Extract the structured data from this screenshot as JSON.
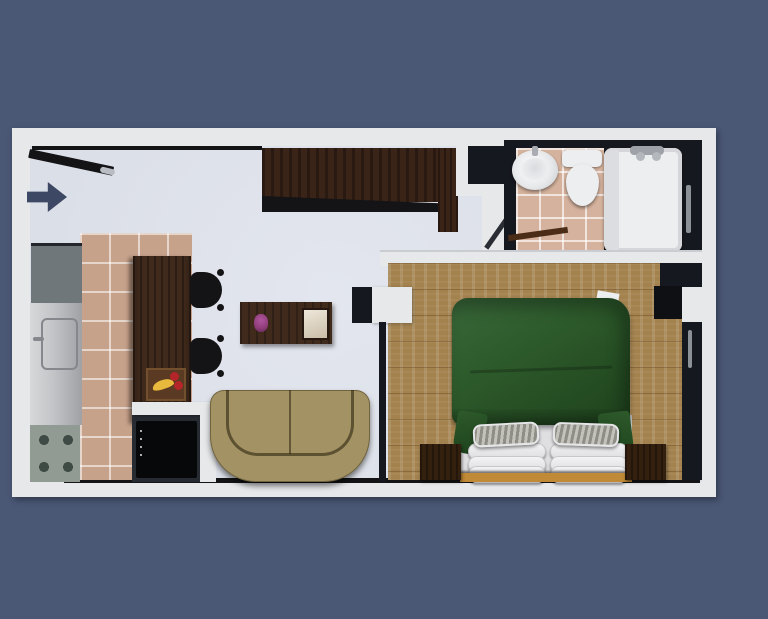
{
  "meta": {
    "description": "3D rendered top-down floor plan of a studio apartment",
    "render_style": "architectural color render on slate-blue background"
  },
  "palette": {
    "bg": "#4a5775",
    "wall": "#e7e8ea",
    "floor": "#dbdfe7",
    "black": "#141416",
    "window": "#16181f",
    "tile": "#c7a28b",
    "bathtile": "#d4b29d",
    "wood": "#a3824e",
    "darkwood": "#3a2317",
    "tablewood": "#402a1c",
    "counter": "#6f777a",
    "stove": "#919b94",
    "tv": "#07080a",
    "pocket": "#262a31",
    "sofa": "#a39263",
    "green": "#2d5a2b",
    "greendark": "#1e421c",
    "bedframe": "#c08a36",
    "fixture": "#eceef0",
    "handle": "#8c9097",
    "arrow": "#3d4964",
    "traywood": "#5a3a22",
    "banana": "#e8b93c",
    "redfruit": "#b32528",
    "flower": "#8e3d78"
  },
  "rooms": {
    "entrance": {
      "label": "Entrance",
      "icon": "entry-direction-arrow",
      "features": [
        "entry door ajar",
        "direction arrow"
      ]
    },
    "kitchen": {
      "label": "Kitchen",
      "furniture": [
        "counter",
        "fridge",
        "stove with 4 burners",
        "dining table",
        "2 black chairs",
        "fruit tray with bananas and red fruit"
      ]
    },
    "living_room": {
      "label": "Living Room",
      "furniture": [
        "wardrobe",
        "coffee table",
        "purple flowers",
        "serving tray",
        "TV on partition",
        "two-seat sofa"
      ]
    },
    "bedroom": {
      "label": "Bedroom",
      "furniture": [
        "double bed with green duvet",
        "white pillow stacks",
        "striped pillows",
        "2 nightstands",
        "dresser",
        "window"
      ]
    },
    "bathroom": {
      "label": "Bathroom",
      "furniture": [
        "pedestal sink",
        "toilet",
        "bathtub with faucet",
        "towel rail",
        "wooden shelf"
      ]
    }
  }
}
